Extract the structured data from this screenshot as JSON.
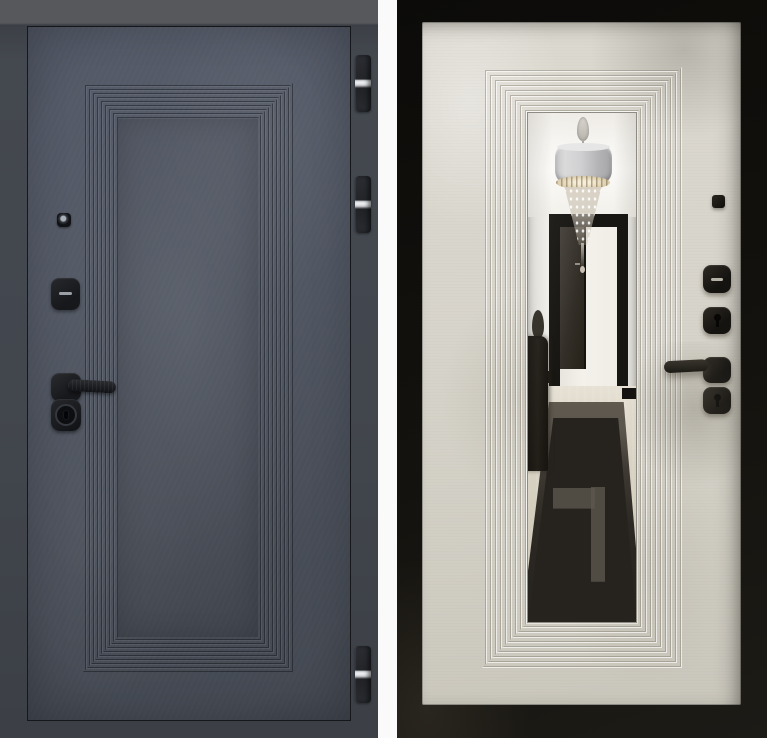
{
  "image": {
    "type": "product-photo-two-views",
    "views": [
      "door-exterior-graphite",
      "door-interior-light-with-mirror"
    ]
  },
  "parts": {
    "left_door": [
      "door-leaf",
      "recessed-panel-ridges",
      "peephole",
      "thumbturn-escutcheon",
      "handle-lever-right",
      "cylinder-escutcheon",
      "hinge-top",
      "hinge-middle",
      "hinge-bottom"
    ],
    "right_door": [
      "black-casing-frame",
      "door-leaf",
      "recessed-panel-ridges",
      "mirror-inlay",
      "small-square-cap",
      "thumbturn-escutcheon",
      "keyhole-escutcheon-upper",
      "handle-lever-left",
      "keyhole-escutcheon-lower"
    ],
    "mirror_reflection": [
      "ceiling",
      "drum-chandelier-with-crystals",
      "hallway-doorway",
      "dark-interior-door",
      "glossy-floor",
      "dark-runner-carpet-with-key-pattern",
      "dark-cabinet-silhouette"
    ]
  },
  "colors": {
    "gap": "#fafafa",
    "left_frame_top": "#57585c",
    "left_leaf": "#4e5460",
    "hardware": "#17181b",
    "hardware_dark": "#151310",
    "hinge_body": "#232529",
    "hinge_pin": "#eef0f2",
    "right_frame": "#14120e",
    "right_leaf": "#d7d4cb",
    "mirror_trim": "#8e8b84",
    "mirror_wall": "#efede8",
    "mirror_ceiling": "#fbfaf7",
    "mirror_doorframe": "#181613",
    "mirror_doorleaf": "#332f28",
    "mirror_floor": "#cfc9b9",
    "runner_dark": "#26231e",
    "runner_light": "#5b564e",
    "chand_shade": "#b4b4b6"
  }
}
